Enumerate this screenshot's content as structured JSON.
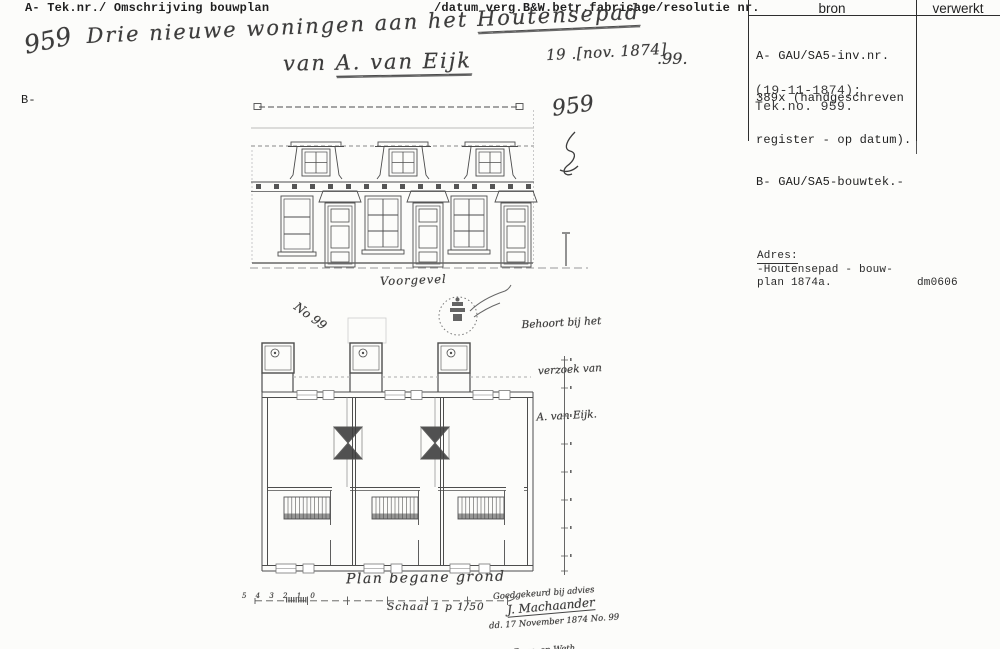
{
  "page": {
    "header_left": "A- Tek.nr./ Omschrijving bouwplan",
    "header_middle": "/datum verg.B&W.betr.fabricage/resolutie nr.",
    "margin_mark": "B-"
  },
  "bron_table": {
    "col_bron": "bron",
    "col_verwerkt": "verwerkt",
    "lines": [
      "A- GAU/SA5-inv.nr.",
      "389x (handgeschreven",
      "register - op datum).",
      "B- GAU/SA5-bouwtek.-"
    ],
    "date_line": "(19-11-1874);",
    "tek_line": "Tek.no. 959."
  },
  "adres_block": {
    "label": "Adres:",
    "line1": "-Houtensepad - bouw-",
    "line2": "plan 1874a.",
    "code": "dm0606"
  },
  "handwriting": {
    "register_number": "959",
    "title_part1": "Drie nieuwe woningen aan het ",
    "title_part2": "Houtensepad",
    "title2_part1": "van ",
    "title2_part2": "A. van Eijk",
    "date": "19 .[nov. 1874]",
    "resolutie_nr": ".99.",
    "tek_number": "959",
    "note1": "Behoort bij het",
    "note2": "verzoek van",
    "note3": "A. van Eijk.",
    "plan_mark": "No 99",
    "caption_voorgevel": "Voorgevel",
    "caption_plan": "Plan begane grond",
    "caption_schaal": "Schaal 1 p 1/50",
    "scale_figures": "5 4 3 2 1 0",
    "approval1": "Goedgekeurd bij advies",
    "approval2": "dd. 17 November 1874 No. 99",
    "approval3": "De Burg. en Weth.",
    "signature": "J. Machaander"
  }
}
